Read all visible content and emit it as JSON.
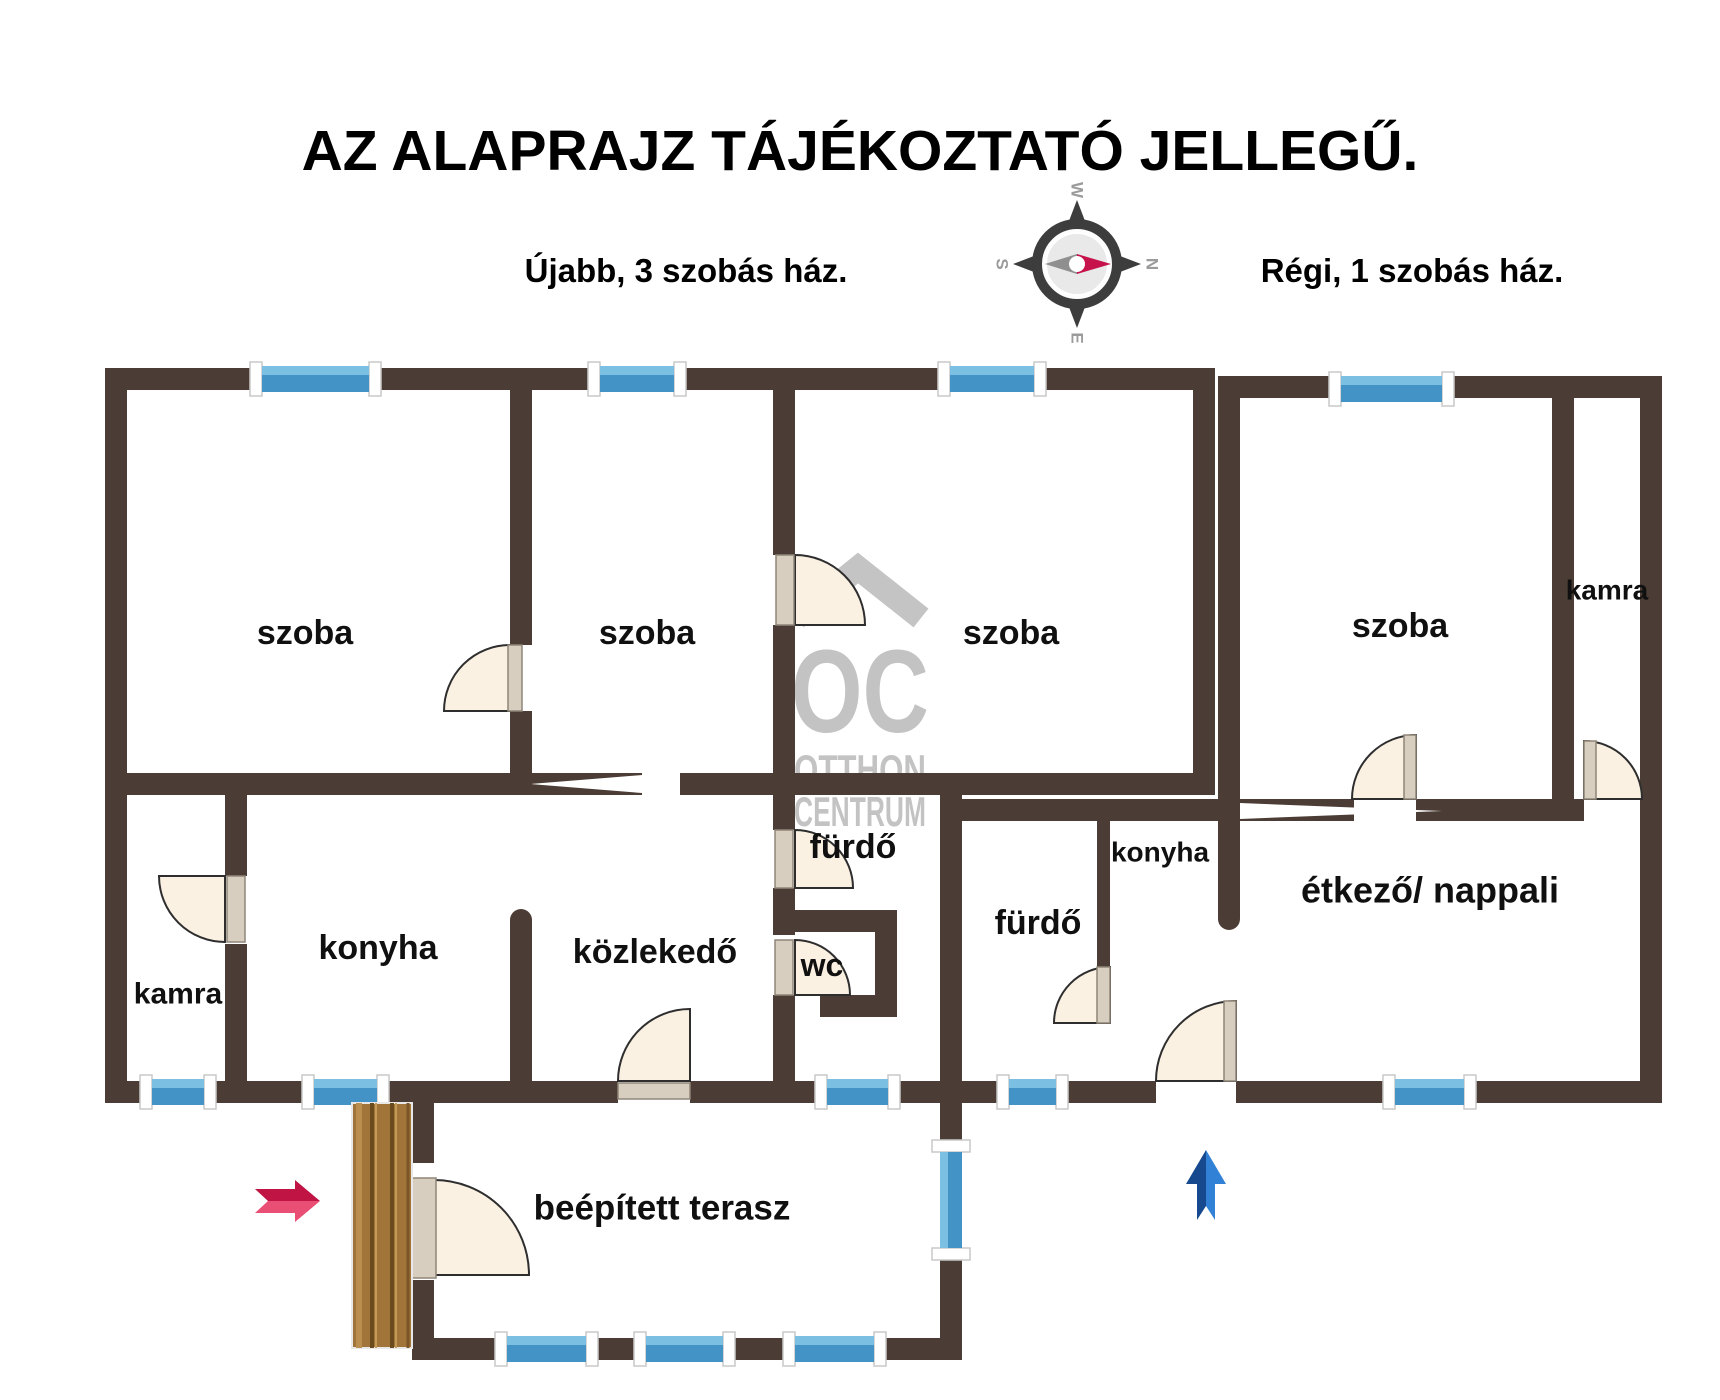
{
  "title": "AZ ALAPRAJZ TÁJÉKOZTATÓ JELLEGŰ.",
  "subtitle_left": "Újabb, 3 szobás ház.",
  "subtitle_right": "Régi, 1 szobás ház.",
  "compass": {
    "west": "W",
    "north": "N",
    "east": "E",
    "south": "S"
  },
  "watermark": {
    "logo": "OC",
    "line1": "OTTHON",
    "line2": "CENTRUM"
  },
  "rooms": {
    "szoba1": "szoba",
    "szoba2": "szoba",
    "szoba3": "szoba",
    "szoba4": "szoba",
    "kamra_left": "kamra",
    "kamra_right": "kamra",
    "konyha_left": "konyha",
    "konyha_right": "konyha",
    "kozlekedo": "közlekedő",
    "furdo_left": "fürdő",
    "furdo_right": "fürdő",
    "wc": "wc",
    "etkezo_nappali": "étkező/ nappali",
    "terasz": "beépített terasz"
  },
  "colors": {
    "wall": "#4b3d35",
    "window_blue": "#4493c6",
    "window_blue_light": "#7bbfe2",
    "door_fill": "#faf1e3",
    "door_leaf": "#d8cec0",
    "red_arrow_dark": "#c01445",
    "red_arrow_light": "#e94e74",
    "blue_arrow_dark": "#17498f",
    "blue_arrow_light": "#3181d6",
    "watermark_gray": "#c3c3c3",
    "wood_door": "#a1743a",
    "compass_dark": "#3d3d3d",
    "compass_needle_red": "#c6134b"
  }
}
